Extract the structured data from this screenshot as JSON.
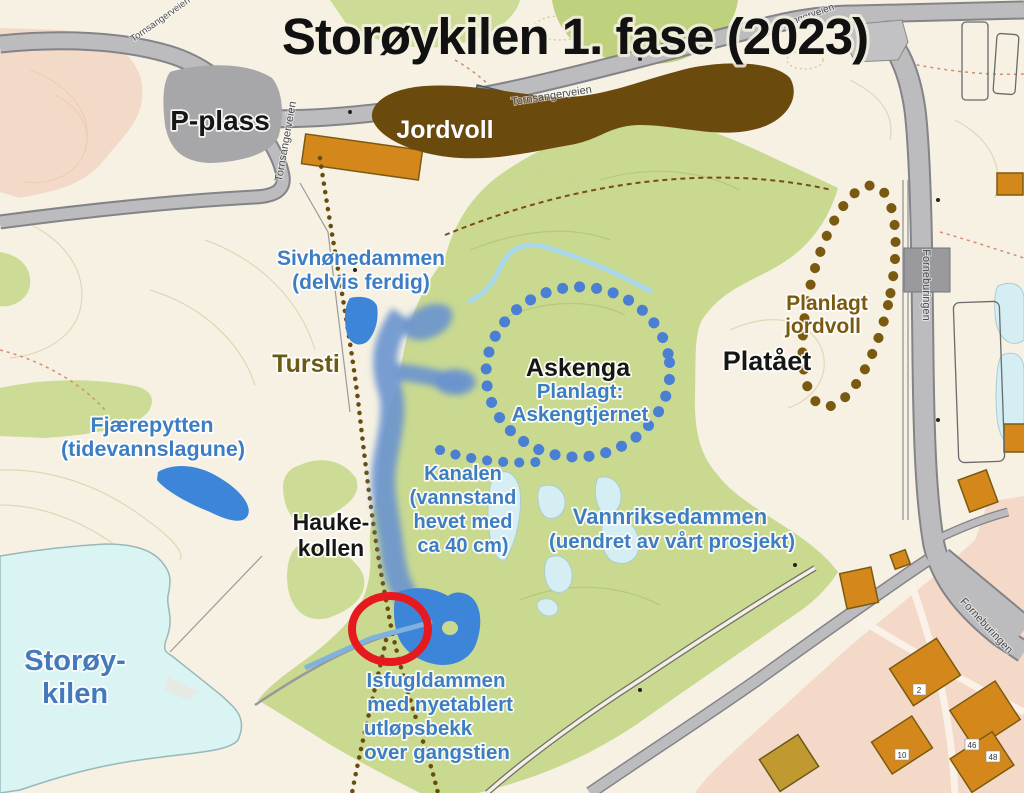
{
  "title": "Storøykilen 1. fase (2023)",
  "labels": {
    "p_plass": "P-plass",
    "jordvoll": "Jordvoll",
    "sivhonedammen": [
      "Sivhønedammen",
      "(delvis ferdig)"
    ],
    "tursti": "Tursti",
    "fjaerepytten": [
      "Fjærepytten",
      "(tidevannslagune)"
    ],
    "askenga": "Askenga",
    "askengtjernet": [
      "Planlagt:",
      "Askengtjernet"
    ],
    "plataaet": "Platået",
    "planlagt_jordvoll": [
      "Planlagt",
      "jordvoll"
    ],
    "kanalen": [
      "Kanalen",
      "(vannstand",
      "hevet med",
      "ca 40 cm)"
    ],
    "vannriksedammen": [
      "Vannriksedammen",
      "(uendret av vårt prosjekt)"
    ],
    "haukekollen": [
      "Hauke-",
      "kollen"
    ],
    "storoykilen": [
      "Storøy-",
      "kilen"
    ],
    "isfugldammen": [
      "Isfugldammen",
      "med nyetablert",
      "utløpsbekk",
      "over gangstien"
    ]
  },
  "streets": {
    "tornsangerveien": "Tornsangerveien",
    "forneburingen": "Forneburingen"
  },
  "building_numbers": [
    "2",
    "10",
    "46",
    "48"
  ],
  "colors": {
    "background": "#f6f1e2",
    "green": "#c9d990",
    "pink": "#f3dac8",
    "bay_water": "#d9f4f2",
    "pale_pond": "#d5eef3",
    "solid_pond": "#3d85d8",
    "canal": "#6a93cf",
    "dotted_blue": "#4a7fd4",
    "earthwork_brown": "#6b4a0e",
    "planned_brown": "#7a5a10",
    "highlight_red": "#e6191f",
    "road_fill": "#bcbcbe",
    "road_casing": "#83838a",
    "parking_gray": "#a7a7a9",
    "label_blue": "#3d7dc4"
  }
}
